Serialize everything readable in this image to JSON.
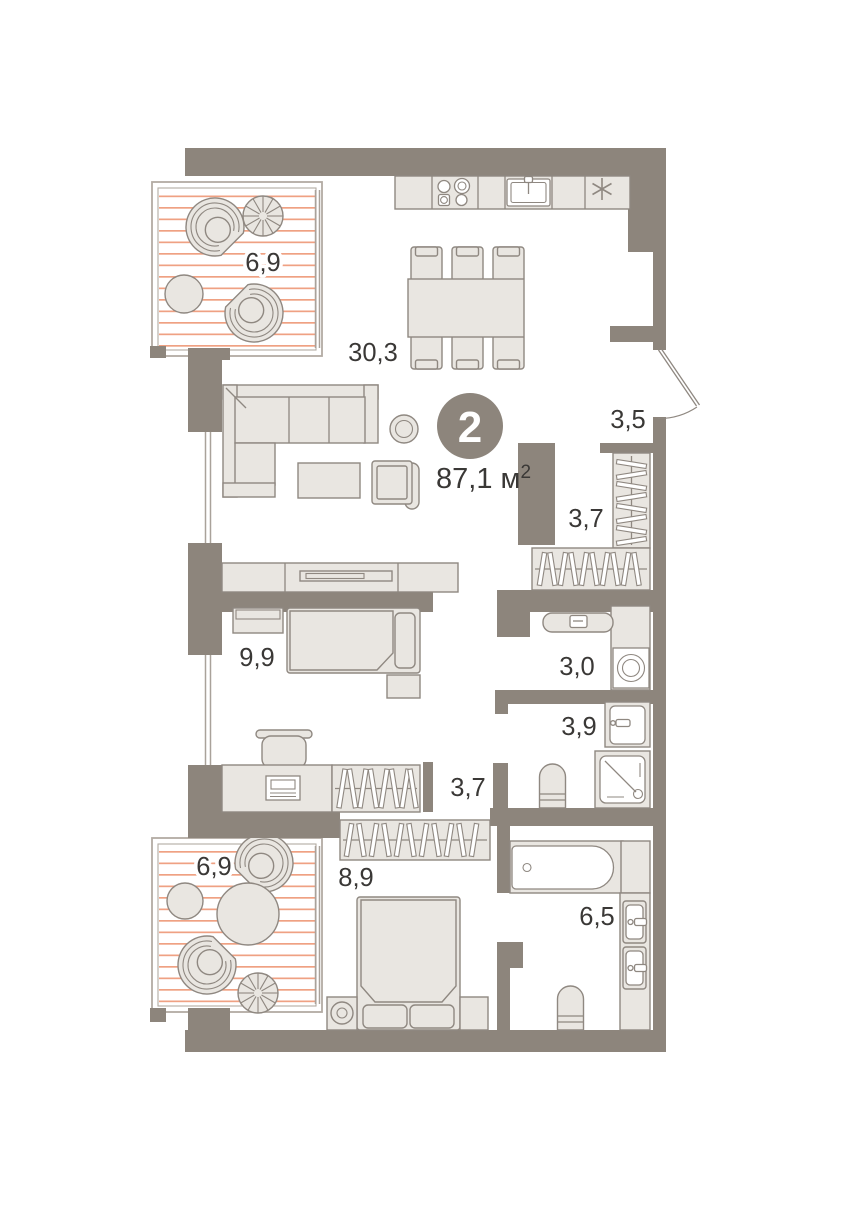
{
  "apartment": {
    "rooms_badge": "2",
    "area_value": "87,1",
    "area_unit": "м",
    "area_sup": "2"
  },
  "rooms": [
    {
      "id": "balcony-top",
      "area": "6,9"
    },
    {
      "id": "living-kitchen",
      "area": "30,3"
    },
    {
      "id": "hallway",
      "area": "3,5"
    },
    {
      "id": "wardrobe",
      "area": "3,7"
    },
    {
      "id": "laundry",
      "area": "3,0"
    },
    {
      "id": "bedroom-small",
      "area": "9,9"
    },
    {
      "id": "bathroom-small",
      "area": "3,9"
    },
    {
      "id": "corridor",
      "area": "3,7"
    },
    {
      "id": "balcony-bottom",
      "area": "6,9"
    },
    {
      "id": "bedroom-master",
      "area": "8,9"
    },
    {
      "id": "bathroom-master",
      "area": "6,5"
    }
  ],
  "icons": {
    "fridge": "snowflake-icon"
  },
  "colors": {
    "wall": "#8d857c",
    "furn": "#e9e6e1",
    "fstroke": "#8f8881",
    "wstroke": "#a9a29a",
    "frame": "#b2aba3",
    "stripe": "#efa183",
    "ink": "#3a3836",
    "badgetxt": "#ffffff",
    "bg": "#ffffff"
  }
}
